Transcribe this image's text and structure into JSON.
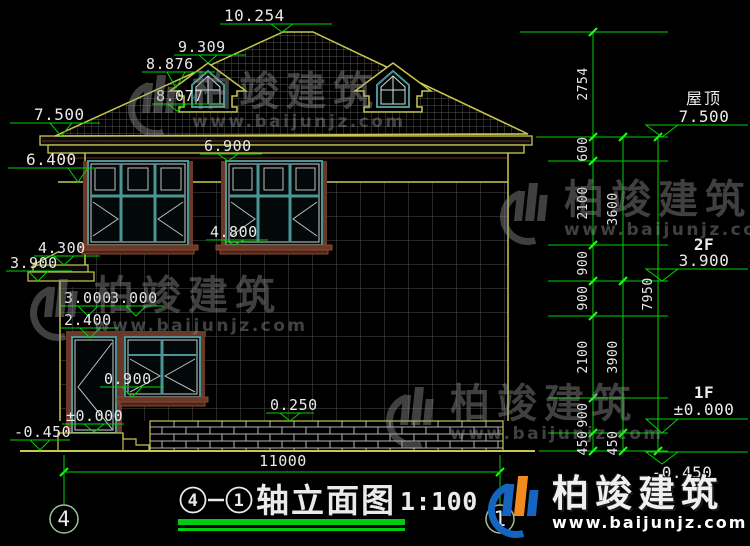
{
  "page": {
    "background": "#000000",
    "kind": "CAD elevation drawing"
  },
  "colors": {
    "annotation_green": "#00d400",
    "tick_green": "#1aff1a",
    "cad_yellow": "#c8c84f",
    "frame_teal": "#4a9595",
    "trim_brown": "#6b3726",
    "text_white": "#eaeaea",
    "logo_blue": "#1565c0",
    "logo_orange": "#f08c1e",
    "watermark_grey": "#9a9a9a"
  },
  "drawing": {
    "left_levels": [
      {
        "label": "10.254"
      },
      {
        "label": "9.309"
      },
      {
        "label": "8.876"
      },
      {
        "label": "8.077"
      },
      {
        "label": "7.500"
      },
      {
        "label": "6.900"
      },
      {
        "label": "6.400"
      },
      {
        "label": "4.800"
      },
      {
        "label": "4.300"
      },
      {
        "label": "3.900"
      },
      {
        "label": "3.000"
      },
      {
        "label": "3.000"
      },
      {
        "label": "2.400"
      },
      {
        "label": "0.900"
      },
      {
        "label": "0.250"
      },
      {
        "label": "±0.000"
      },
      {
        "label": "-0.450"
      }
    ],
    "right_levels": [
      {
        "floor": "屋顶",
        "value": "7.500"
      },
      {
        "floor": "2F",
        "value": "3.900"
      },
      {
        "floor": "1F",
        "value": "±0.000"
      },
      {
        "floor": "",
        "value": "-0.450"
      }
    ],
    "dim_chains": {
      "inner": [
        "2754",
        "600",
        "2100",
        "900",
        "900",
        "2100",
        "900",
        "450"
      ],
      "mid": [
        "3600",
        "3900",
        "450"
      ],
      "outer": [
        "7950"
      ]
    },
    "bottom_dimension": "11000",
    "axes": [
      {
        "id": "4"
      },
      {
        "id": "1"
      }
    ],
    "title": {
      "bubble_left": "4",
      "separator": "-",
      "bubble_right": "1",
      "text": "轴立面图",
      "scale": "1:100"
    }
  },
  "watermark": {
    "brand": "柏竣建筑",
    "url": "www.baijunjz.com"
  }
}
